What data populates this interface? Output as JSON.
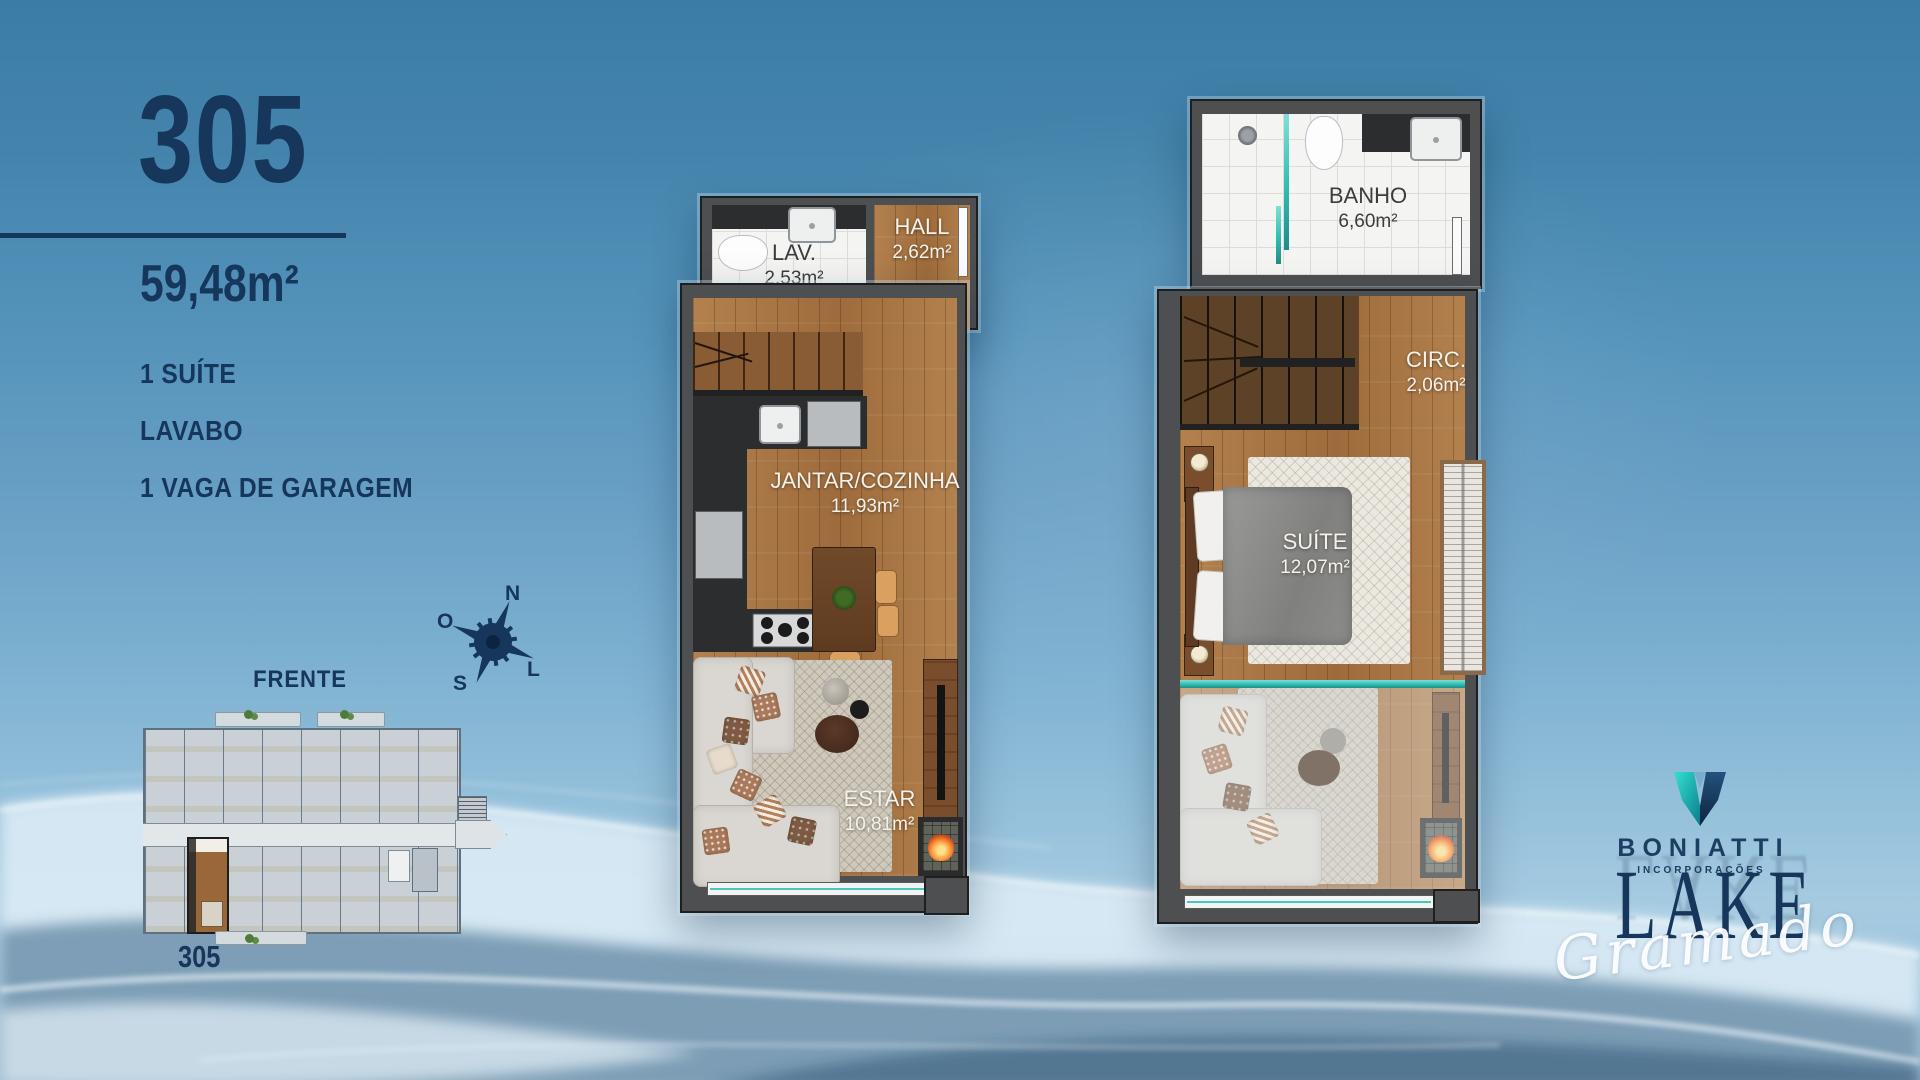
{
  "unit": {
    "number": "305",
    "area": "59,48m²",
    "features": [
      "1 SUÍTE",
      "LAVABO",
      "1 VAGA DE GARAGEM"
    ]
  },
  "compass": {
    "n": "N",
    "o": "O",
    "s": "S",
    "l": "L"
  },
  "keyplan": {
    "front_label": "FRENTE",
    "unit_label": "305"
  },
  "floor1": {
    "rooms": [
      {
        "name": "LAV.",
        "area": "2,53m²"
      },
      {
        "name": "HALL",
        "area": "2,62m²"
      },
      {
        "name": "JANTAR/COZINHA",
        "area": "11,93m²"
      },
      {
        "name": "ESTAR",
        "area": "10,81m²"
      }
    ]
  },
  "floor2": {
    "rooms": [
      {
        "name": "BANHO",
        "area": "6,60m²"
      },
      {
        "name": "CIRC.",
        "area": "2,06m²"
      },
      {
        "name": "SUÍTE",
        "area": "12,07m²"
      }
    ]
  },
  "branding": {
    "developer": "BONIATTI",
    "developer_sub": "INCORPORAÇÕES",
    "project_name": "LAKE",
    "project_sub": "Gramado"
  },
  "colors": {
    "navy": "#16365c",
    "teal": "#2fbdb3",
    "wood": "#ac7845",
    "wall_gray": "#4e4f51",
    "background_top": "#3b7ca6",
    "background_bottom": "#8fb6d2"
  }
}
